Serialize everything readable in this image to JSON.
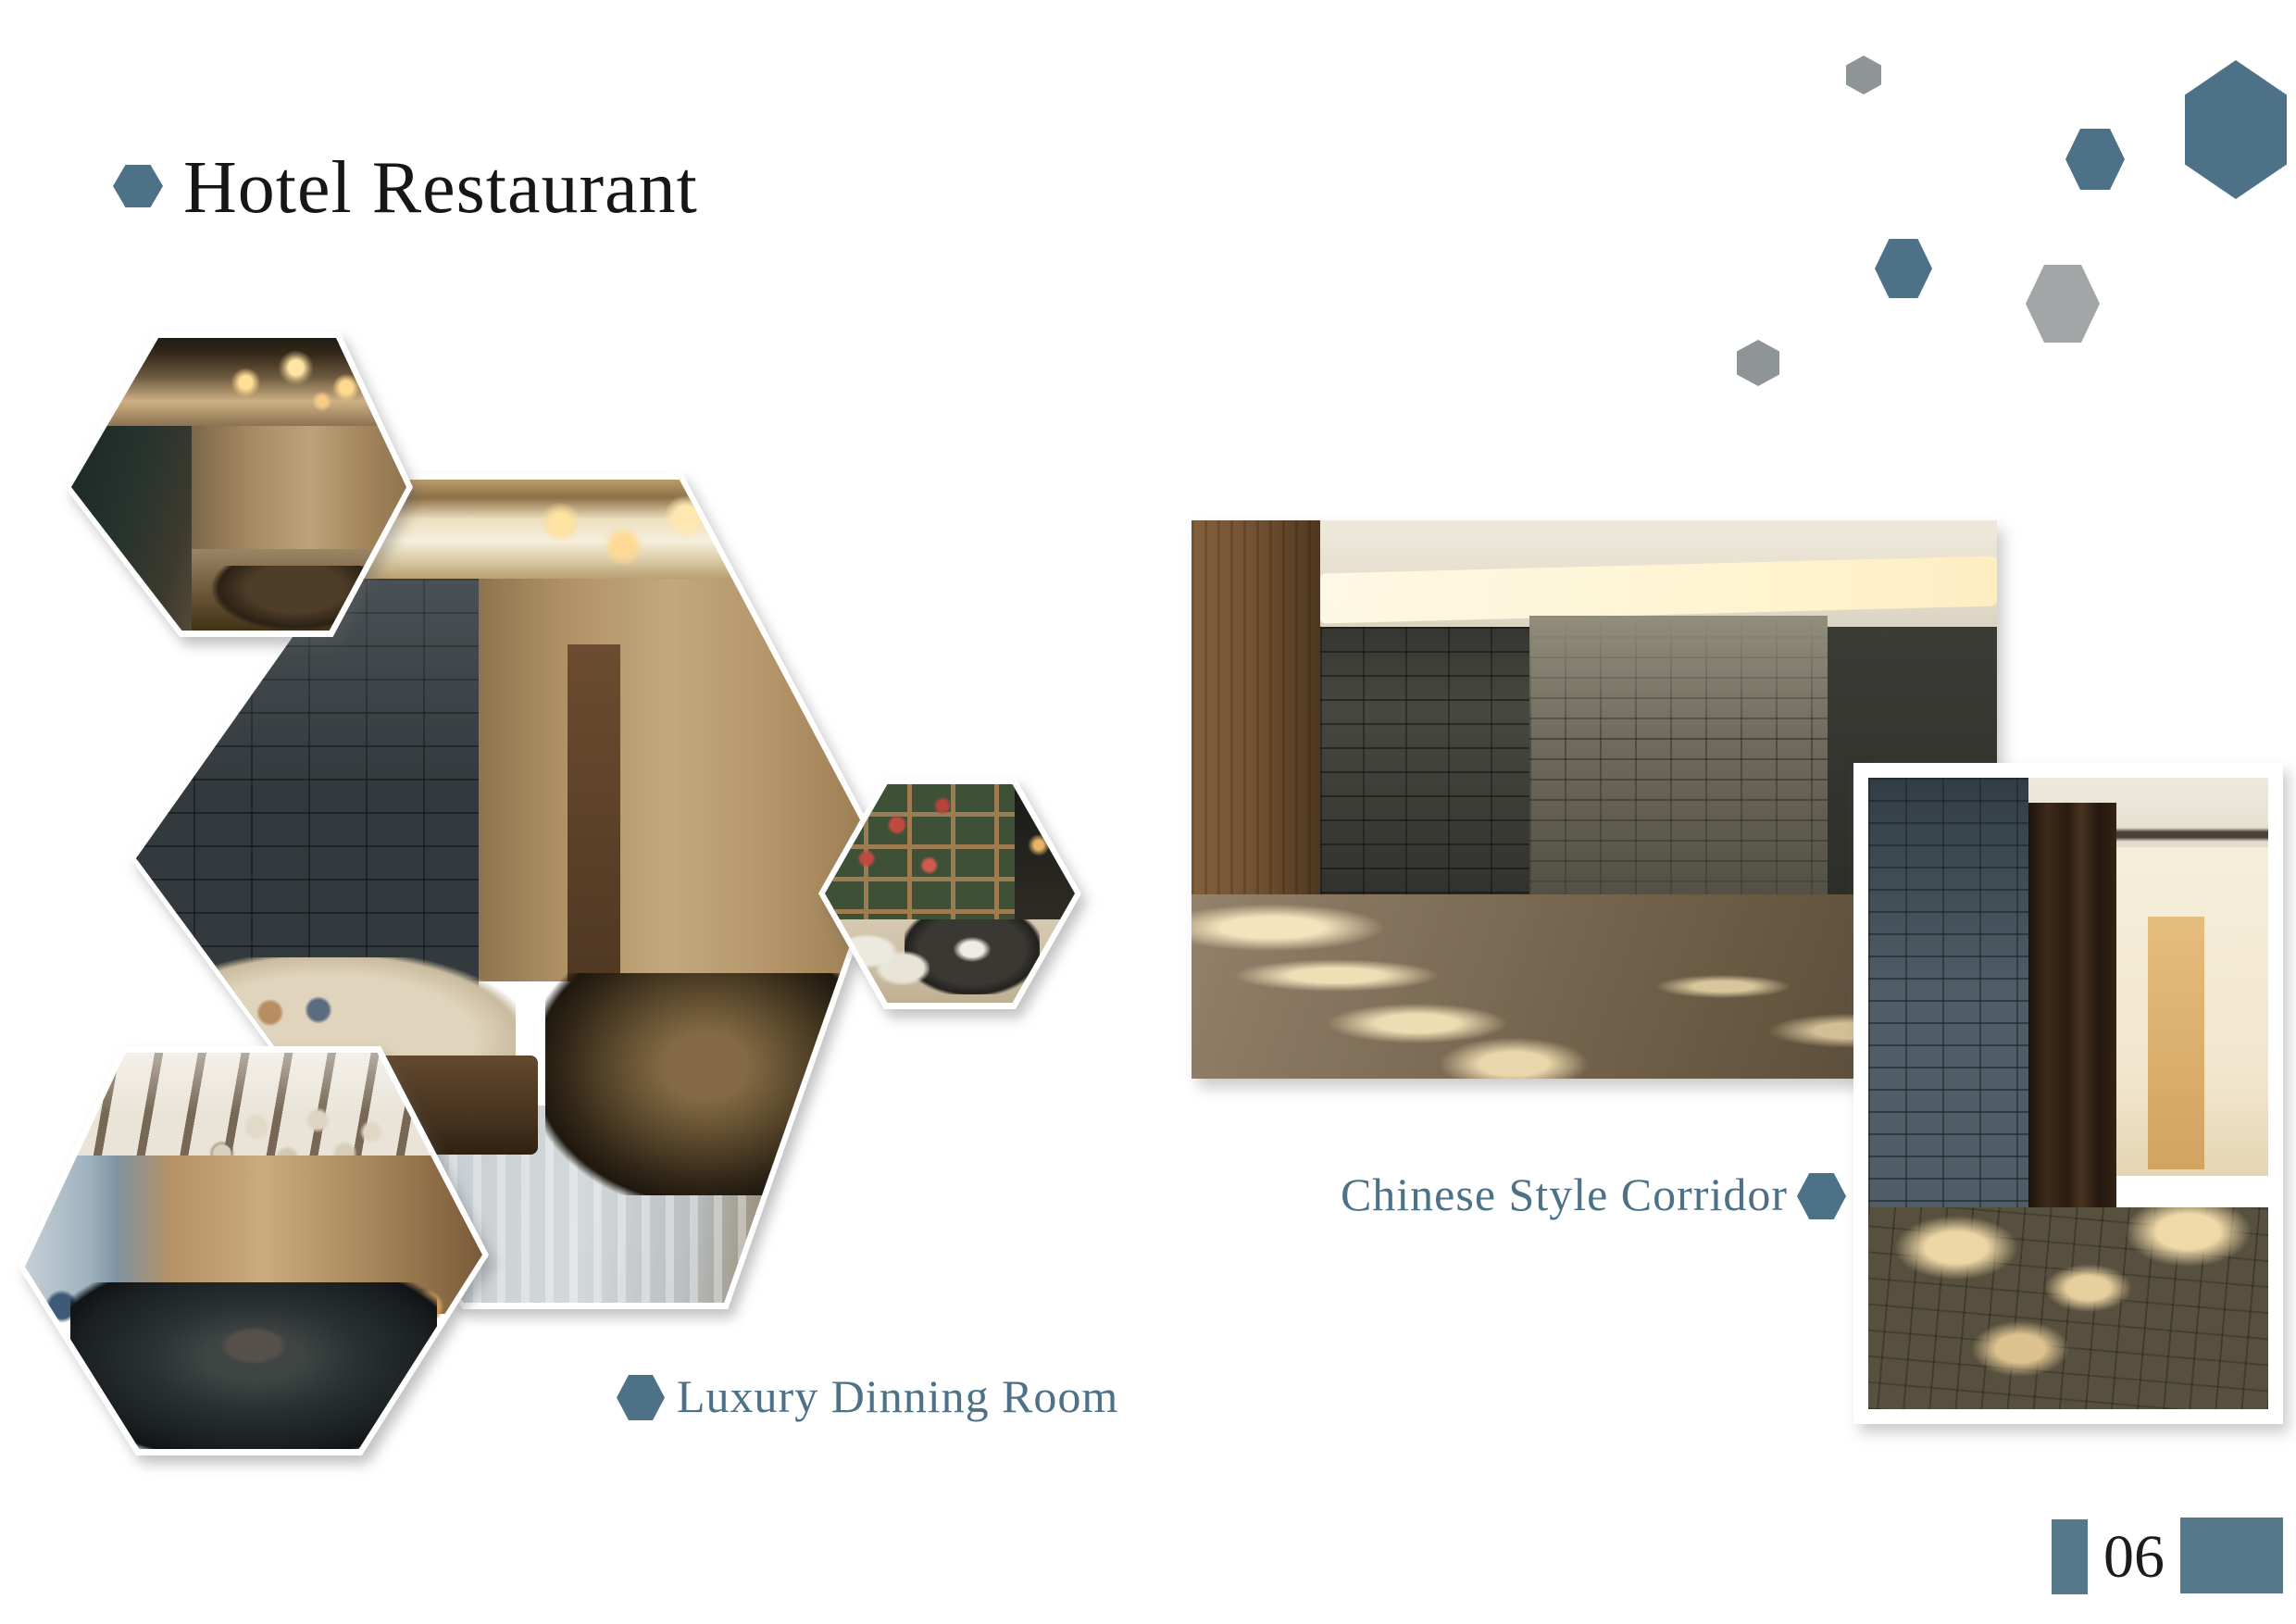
{
  "header": {
    "title": "Hotel Restaurant"
  },
  "captions": {
    "dining_room": "Luxury Dinning Room",
    "corridor": "Chinese Style Corridor"
  },
  "footer": {
    "page_number": "06"
  },
  "photos": {
    "hex_top_left": "private dining room with gold chandelier and mirror wall",
    "hex_center": "luxury dining room with slate stone wall, sofa and round table",
    "hex_right": "tea room with plant shelf wall and round table",
    "hex_bottom_left": "dining room with glass bubble chandelier and big round table",
    "rect_left": "corridor with rough stone wall and cove lighting",
    "rect_right": "corridor with stone wall, wooden doors and lit end wall"
  },
  "colors": {
    "accent_blue": "#4d7186",
    "decorative_gray": "#8f9496",
    "decorative_gray_light": "#a1a5a6",
    "footer_rect_blue": "#56788b",
    "title_text": "#161616"
  }
}
